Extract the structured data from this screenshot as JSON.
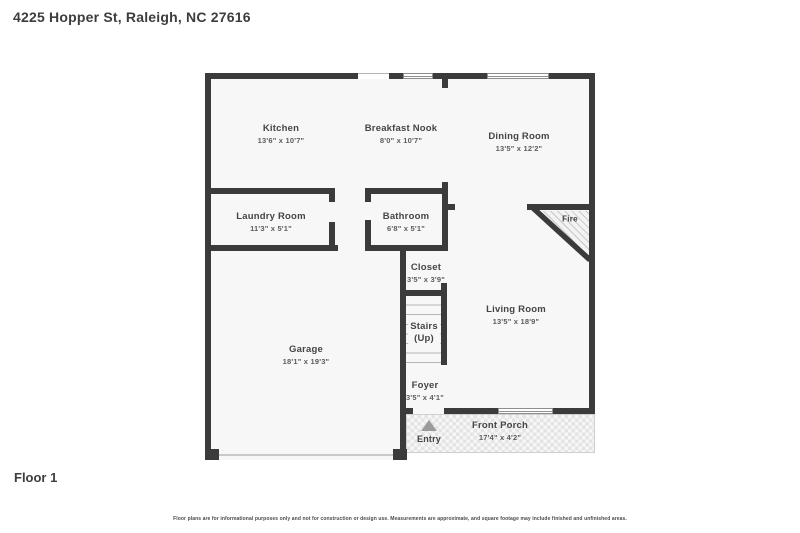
{
  "title": "4225 Hopper St, Raleigh, NC 27616",
  "floor_label": "Floor 1",
  "disclaimer": "Floor plans are for informational purposes only and not for construction or design use. Measurements are approximate, and square footage may include finished and unfinished areas.",
  "rooms": {
    "kitchen": {
      "name": "Kitchen",
      "dims": "13'6\" x 10'7\""
    },
    "breakfast_nook": {
      "name": "Breakfast Nook",
      "dims": "8'0\" x 10'7\""
    },
    "dining_room": {
      "name": "Dining Room",
      "dims": "13'5\" x 12'2\""
    },
    "laundry_room": {
      "name": "Laundry Room",
      "dims": "11'3\" x 5'1\""
    },
    "bathroom": {
      "name": "Bathroom",
      "dims": "6'8\" x 5'1\""
    },
    "closet": {
      "name": "Closet",
      "dims": "3'5\" x 3'9\""
    },
    "stairs": {
      "name": "Stairs",
      "direction": "(Up)"
    },
    "living_room": {
      "name": "Living Room",
      "dims": "13'5\" x 18'9\""
    },
    "garage": {
      "name": "Garage",
      "dims": "18'1\" x 19'3\""
    },
    "foyer": {
      "name": "Foyer",
      "dims": "3'5\" x 4'1\""
    },
    "front_porch": {
      "name": "Front Porch",
      "dims": "17'4\" x 4'2\""
    }
  },
  "annotations": {
    "fire": "Fire",
    "entry": "Entry"
  },
  "colors": {
    "wall": "#3b3b3b",
    "floor": "#f7f7f7",
    "label": "#454545",
    "dims": "#5c5c5c"
  }
}
